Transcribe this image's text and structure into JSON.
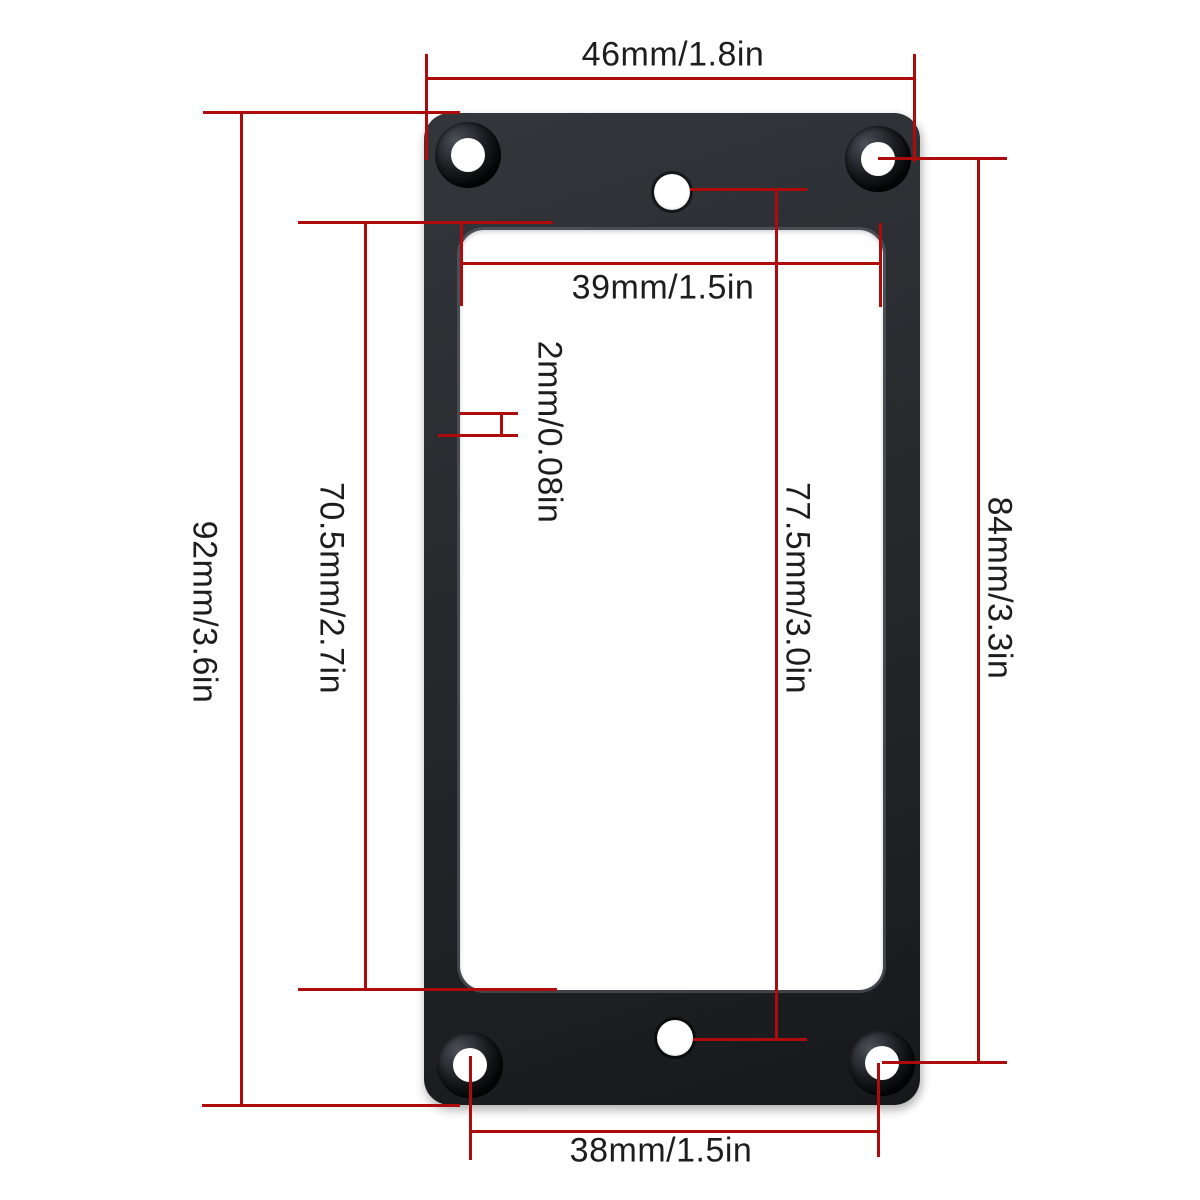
{
  "diagram": {
    "type": "product-dimension-drawing",
    "subject": "flat black humbucker pickup mounting ring, top view",
    "colors": {
      "dimension_line": "#ae0c0c",
      "label_text": "#1d1d1d",
      "frame": "#26282c",
      "background": "#ffffff"
    },
    "dims": {
      "outer_width": {
        "label": "46mm/1.8in"
      },
      "inner_width": {
        "label": "39mm/1.5in"
      },
      "edge_thickness": {
        "label": "2mm/0.08in"
      },
      "outer_height": {
        "label": "92mm/3.6in"
      },
      "inner_height": {
        "label": "70.5mm/2.7in"
      },
      "center_hole_span": {
        "label": "77.5mm/3.0in"
      },
      "screw_hole_span": {
        "label": "84mm/3.3in"
      },
      "bottom_screw_span": {
        "label": "38mm/1.5in"
      }
    }
  }
}
